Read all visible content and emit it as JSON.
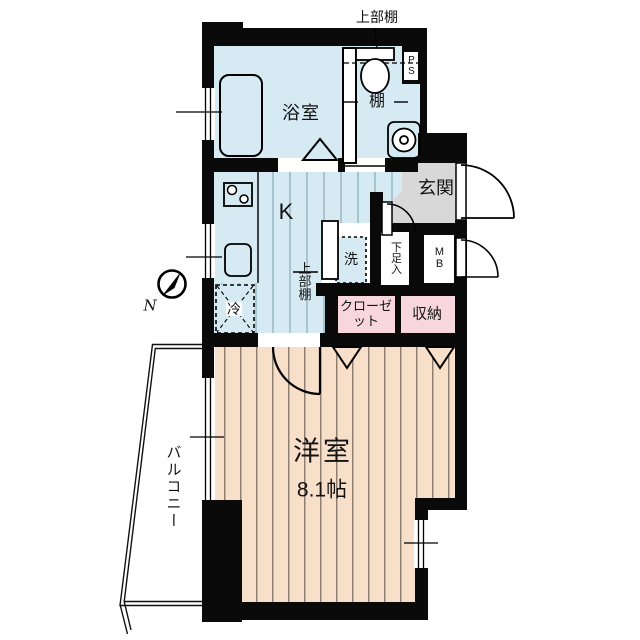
{
  "meta": {
    "type": "apartment-floorplan"
  },
  "colors": {
    "floor_blue": "#d6eaf3",
    "stripe_blue": "#7f9dab",
    "floor_peach": "#f7dfca",
    "stripe_peach": "#6b5d52",
    "pink": "#f7d6e0",
    "entrance_gray": "#d8d8d8",
    "wall": "#0a0a0a"
  },
  "labels": {
    "upper_shelf_top": "上部棚",
    "bathroom": "浴室",
    "shelf": "棚",
    "pipe_space": "PS",
    "entrance": "玄関",
    "kitchen": "K",
    "kitchen_upper_shelf": "上部棚",
    "washer": "洗",
    "fridge": "冷",
    "shoe_cabinet": "下足入",
    "meter_box": "MB",
    "closet": "クローゼット",
    "storage": "収納",
    "western_room": "洋室",
    "western_room_size": "8.1帖",
    "balcony": "バルコニー",
    "compass_north": "N"
  }
}
